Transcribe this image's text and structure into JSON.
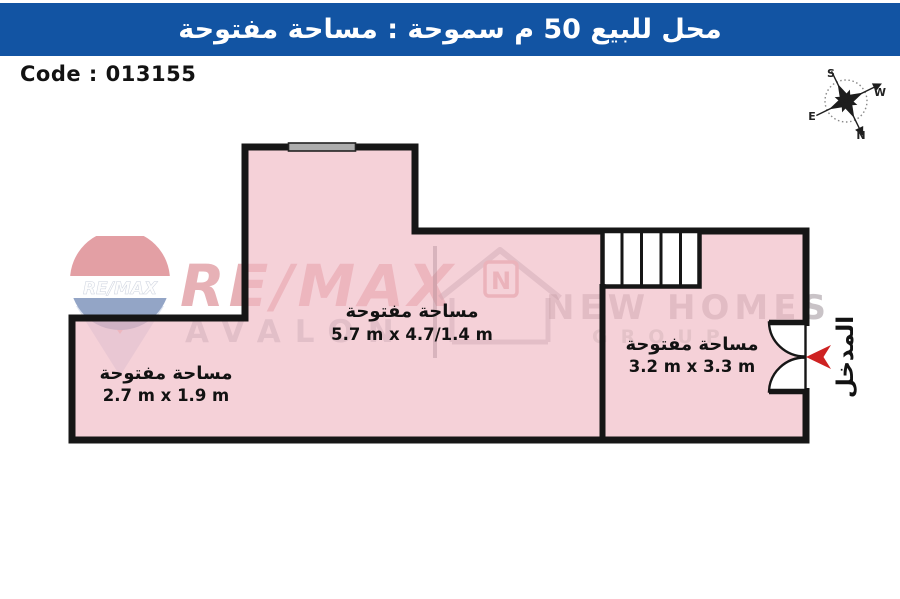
{
  "header": {
    "title": "محل للبيع 50 م سموحة :  مساحة مفتوحة"
  },
  "code": {
    "label": "Code : 013155"
  },
  "compass": {
    "north": "N",
    "south": "S",
    "east": "E",
    "west": "W"
  },
  "plan": {
    "rooms": [
      {
        "label": "مساحة مفتوحة",
        "dims": "5.7 m x 4.7/1.4 m"
      },
      {
        "label": "مساحة مفتوحة",
        "dims": "2.7 m x 1.9 m"
      },
      {
        "label": "مساحة مفتوحة",
        "dims": "3.2 m x 3.3 m"
      }
    ],
    "entrance_label": "المدخل",
    "colors": {
      "room_fill": "#F8D9DC",
      "wall": "#161616",
      "entrance_arrow": "#CE2222",
      "header_bar": "#1254A3"
    }
  },
  "watermarks": {
    "remax": "RE/MAX",
    "avalon": "AVALON",
    "new_homes": "NEW HOMES",
    "group": "GROUP",
    "balloon_text": "RE/MAX",
    "house_letter": "N"
  }
}
